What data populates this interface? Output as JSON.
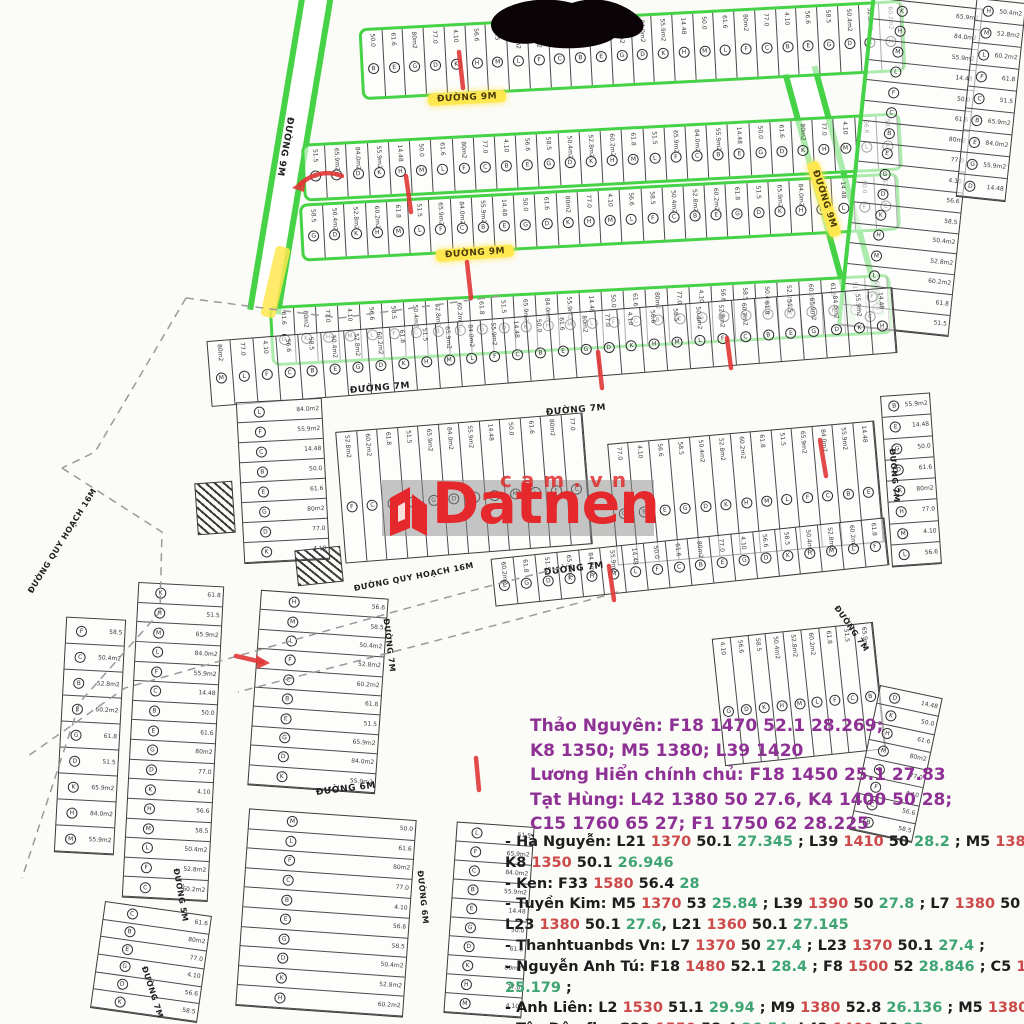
{
  "map": {
    "plot_labels": [
      "B",
      "E",
      "G",
      "D",
      "K",
      "H",
      "M",
      "L",
      "F",
      "C"
    ],
    "plot_areas": [
      "50.0",
      "51.5",
      "58.5",
      "61.6",
      "65.9m2",
      "50.4m2",
      "80m2",
      "84.0m2",
      "52.8m2",
      "77.0",
      "55.9m2",
      "60.2m2",
      "4.10",
      "14.48",
      "61.8",
      "56.6"
    ]
  },
  "roads": [
    {
      "label": "ĐƯỜNG 9M"
    },
    {
      "label": "ĐƯỜNG 9M"
    },
    {
      "label": "ĐƯỜNG 9M"
    },
    {
      "label": "ĐƯỜNG 9M"
    },
    {
      "label": "ĐƯỜNG 7M"
    },
    {
      "label": "ĐƯỜNG 7M"
    },
    {
      "label": "ĐƯỜNG 7M"
    },
    {
      "label": "ĐƯỜNG 7M"
    },
    {
      "label": "ĐƯỜNG 7M"
    },
    {
      "label": "ĐƯỜNG 7M"
    },
    {
      "label": "ĐƯỜNG QUY HOẠCH 16M"
    },
    {
      "label": "ĐƯỜNG QUY HOẠCH 16M"
    },
    {
      "label": "ĐƯỜNG 6M"
    },
    {
      "label": "ĐƯỜNG 6M"
    },
    {
      "label": "ĐƯỜNG 5M"
    },
    {
      "label": "ĐƯỜNG 7M"
    }
  ],
  "watermark": {
    "brand": "Datnen",
    "domain_suffix": "cam.vn"
  },
  "listings": {
    "owner_color": "#8e3194",
    "colors": {
      "b": "#1d1d1d",
      "r": "#cd4a4a",
      "g": "#3fa473"
    },
    "owner_lines": [
      "Thảo Nguyên: F18 1470 52.1 28.269;",
      "K8 1350; M5 1380; L39 1420",
      "Lương Hiển chính chủ: F18 1450 25.1 27.83",
      "Tạt Hùng: L42 1380 50 27.6, K4 1400 50 28;",
      "C15 1760 65 27; F1 1750 62 28.225"
    ],
    "agent_lines": [
      [
        [
          "b",
          "- Hà Nguyễn: L21 "
        ],
        [
          "r",
          "1370"
        ],
        [
          "b",
          " 50.1 "
        ],
        [
          "g",
          "27.345"
        ],
        [
          "b",
          " ;  L39 "
        ],
        [
          "r",
          "1410"
        ],
        [
          "b",
          " 50 "
        ],
        [
          "g",
          "28.2"
        ],
        [
          "b",
          " ; M5 "
        ],
        [
          "r",
          "1380"
        ],
        [
          "b",
          " 53 "
        ],
        [
          "g",
          "26"
        ],
        [
          "b",
          " ;"
        ]
      ],
      [
        [
          "b",
          "K8 "
        ],
        [
          "r",
          "1350"
        ],
        [
          "b",
          " 50.1 "
        ],
        [
          "g",
          "26.946"
        ]
      ],
      [
        [
          "b",
          "- Ken: F33 "
        ],
        [
          "r",
          "1580"
        ],
        [
          "b",
          " 56.4 "
        ],
        [
          "g",
          "28"
        ]
      ],
      [
        [
          "b",
          "- Tuyền Kim: M5 "
        ],
        [
          "r",
          "1370"
        ],
        [
          "b",
          " 53 "
        ],
        [
          "g",
          "25.84"
        ],
        [
          "b",
          " ; L39 "
        ],
        [
          "r",
          "1390"
        ],
        [
          "b",
          " 50 "
        ],
        [
          "g",
          "27.8"
        ],
        [
          "b",
          " ; L7 "
        ],
        [
          "r",
          "1380"
        ],
        [
          "b",
          " 50 "
        ],
        [
          "g",
          "27.6"
        ],
        [
          "b",
          " ;"
        ]
      ],
      [
        [
          "b",
          "L23 "
        ],
        [
          "r",
          "1380"
        ],
        [
          "b",
          " 50.1 "
        ],
        [
          "g",
          "27.6"
        ],
        [
          "b",
          ", L21 "
        ],
        [
          "r",
          "1360"
        ],
        [
          "b",
          " 50.1 "
        ],
        [
          "g",
          "27.145"
        ]
      ],
      [
        [
          "b",
          "- Thanhtuanbds Vn: L7 "
        ],
        [
          "r",
          "1370"
        ],
        [
          "b",
          " 50 "
        ],
        [
          "g",
          "27.4"
        ],
        [
          "b",
          " ; L23 "
        ],
        [
          "r",
          "1370"
        ],
        [
          "b",
          " 50.1 "
        ],
        [
          "g",
          "27.4"
        ],
        [
          "b",
          " ;"
        ]
      ],
      [
        [
          "b",
          "- Nguyễn Anh Tú: F18 "
        ],
        [
          "r",
          "1480"
        ],
        [
          "b",
          " 52.1 "
        ],
        [
          "g",
          "28.4"
        ],
        [
          "b",
          " ; F8 "
        ],
        [
          "r",
          "1500"
        ],
        [
          "b",
          " 52 "
        ],
        [
          "g",
          "28.846"
        ],
        [
          "b",
          " ; C5 "
        ],
        [
          "r",
          "1760"
        ],
        [
          "b",
          " 69.9"
        ]
      ],
      [
        [
          "g",
          "25.179"
        ],
        [
          "b",
          " ;"
        ]
      ],
      [
        [
          "b",
          "- Anh Liên: L2 "
        ],
        [
          "r",
          "1530"
        ],
        [
          "b",
          " 51.1 "
        ],
        [
          "g",
          "29.94"
        ],
        [
          "b",
          " ; M9 "
        ],
        [
          "r",
          "1380"
        ],
        [
          "b",
          " 52.8 "
        ],
        [
          "g",
          "26.136"
        ],
        [
          "b",
          " ; M5 "
        ],
        [
          "r",
          "1380"
        ],
        [
          "b",
          " 53 "
        ],
        [
          "g",
          "26.037"
        ]
      ],
      [
        [
          "b",
          "- Tây Dâu fb : G22 "
        ],
        [
          "r",
          "1550"
        ],
        [
          "b",
          " 58.4 "
        ],
        [
          "g",
          "26.54"
        ],
        [
          "b",
          " ;L42 "
        ],
        [
          "r",
          "1400"
        ],
        [
          "b",
          " 50 "
        ],
        [
          "g",
          "28"
        ],
        [
          "b",
          " ;"
        ]
      ]
    ]
  }
}
